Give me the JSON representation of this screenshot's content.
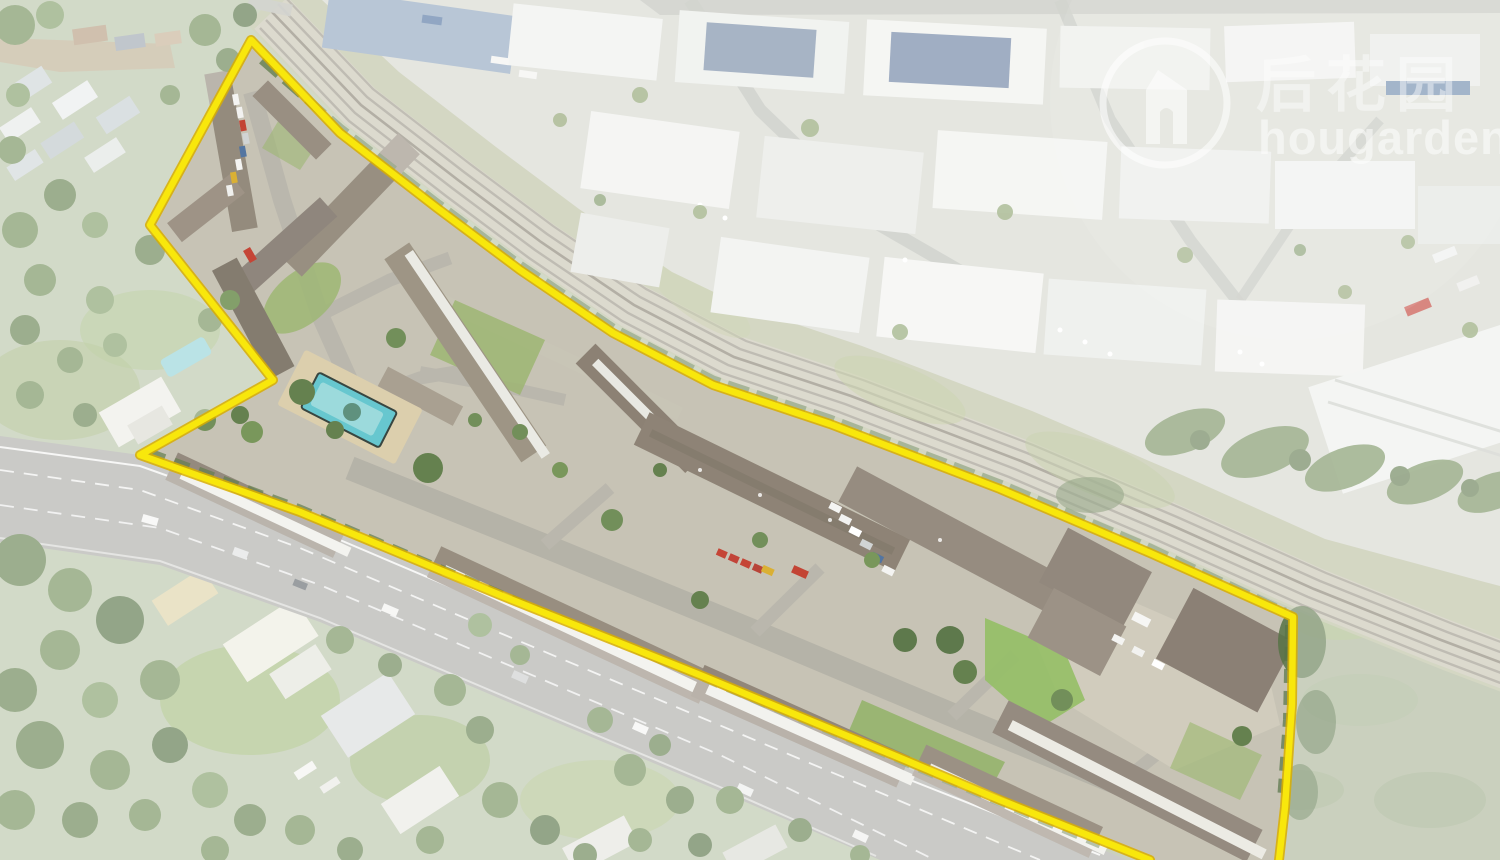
{
  "photo": {
    "kind": "aerial-drone-photograph",
    "subject": "townhouse complex outlined by a yellow site boundary beside a railway corridor, industrial estate, main road and leafy suburb"
  },
  "watermark": {
    "cjk": "后花园",
    "brand": "hougarden",
    "logo_icon": "house-h-logo-icon",
    "color": "#ffffff"
  },
  "colors": {
    "boundary": "#f8e70c",
    "boundary_edge": "#d8ae00",
    "haze": "#ffffff",
    "grass_base": "#b6c2a5",
    "field_green": "#a9b395",
    "road": "#a8a9a4",
    "rail_ballast": "#c6c2b0",
    "rail_track": "#8e8a7b",
    "rail_grass": "#b9bd9e",
    "roof_brown": "#8d8275",
    "facade_white": "#ebebe5",
    "lawn_green": "#9cb671",
    "tree_green": "#5e7b46",
    "industrial_roof": "#eef0ec",
    "solar_panel": "#44598a",
    "pool_water": "#5fc4cd",
    "pool_deck": "#dbcda9",
    "red_vehicle": "#c03a2a",
    "yellow_vehicle": "#d9ac2a"
  }
}
